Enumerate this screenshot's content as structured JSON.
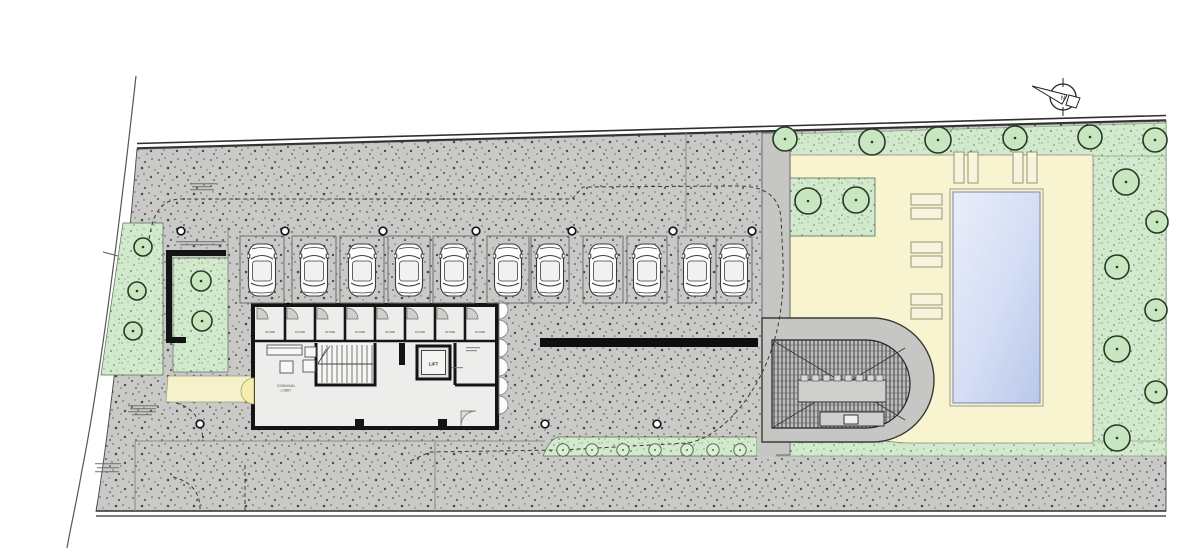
{
  "plan": {
    "labels": {
      "lift": "LIFT",
      "lobby_line1": "COMMUNAL",
      "lobby_line2": "LOBBY",
      "store": "STORE",
      "north": "N"
    },
    "counts": {
      "parking_spaces": 11,
      "storage_rooms": 8,
      "sun_loungers": 10,
      "trees": 20,
      "hedge_bushes": 7
    },
    "colors": {
      "paving_speckled": "#c9c9c7",
      "driveway_gray": "#c6c6c4",
      "lawn_green": "#d3e9cd",
      "pool_deck_yellow": "#f8f4d0",
      "pool_blue": "#c5d4ef",
      "walkway_yellow": "#f5f1cb",
      "wall_black": "#141414"
    },
    "parking": {
      "y": 236,
      "h": 67,
      "bays": [
        [
          240,
          44
        ],
        [
          292,
          44
        ],
        [
          340,
          44
        ],
        [
          388,
          42
        ],
        [
          433,
          42
        ],
        [
          487,
          42
        ],
        [
          531,
          38
        ],
        [
          583,
          40
        ],
        [
          627,
          40
        ],
        [
          678,
          38
        ],
        [
          716,
          36
        ]
      ]
    },
    "trees": [
      [
        143,
        247,
        9
      ],
      [
        137,
        291,
        9
      ],
      [
        133,
        331,
        9
      ],
      [
        201,
        281,
        10
      ],
      [
        202,
        321,
        10
      ],
      [
        808,
        201,
        13
      ],
      [
        856,
        200,
        13
      ],
      [
        785,
        139,
        12
      ],
      [
        872,
        142,
        13
      ],
      [
        938,
        140,
        13
      ],
      [
        1015,
        138,
        12
      ],
      [
        1090,
        137,
        12
      ],
      [
        1155,
        140,
        12
      ],
      [
        1126,
        182,
        13
      ],
      [
        1157,
        222,
        11
      ],
      [
        1117,
        267,
        12
      ],
      [
        1156,
        310,
        11
      ],
      [
        1117,
        349,
        13
      ],
      [
        1156,
        392,
        11
      ],
      [
        1117,
        438,
        13
      ]
    ],
    "bushes": [
      563,
      592,
      623,
      655,
      687,
      713,
      740
    ],
    "bush_y": 450,
    "bollards": [
      [
        181,
        231
      ],
      [
        285,
        231
      ],
      [
        383,
        231
      ],
      [
        476,
        231
      ],
      [
        572,
        231
      ],
      [
        673,
        231
      ],
      [
        752,
        231
      ],
      [
        200,
        424
      ],
      [
        545,
        424
      ],
      [
        657,
        424
      ]
    ],
    "loungers": [
      {
        "x": 911,
        "y": 194,
        "w": 31,
        "h": 11
      },
      {
        "x": 911,
        "y": 208,
        "w": 31,
        "h": 11
      },
      {
        "x": 911,
        "y": 242,
        "w": 31,
        "h": 11
      },
      {
        "x": 911,
        "y": 256,
        "w": 31,
        "h": 11
      },
      {
        "x": 911,
        "y": 294,
        "w": 31,
        "h": 11
      },
      {
        "x": 911,
        "y": 308,
        "w": 31,
        "h": 11
      },
      {
        "x": 954,
        "y": 152,
        "w": 10,
        "h": 31
      },
      {
        "x": 968,
        "y": 152,
        "w": 10,
        "h": 31
      },
      {
        "x": 1013,
        "y": 152,
        "w": 10,
        "h": 31
      },
      {
        "x": 1027,
        "y": 152,
        "w": 10,
        "h": 31
      }
    ],
    "storage": {
      "x0": 255,
      "x1": 495,
      "rooms": 8,
      "top": 307,
      "bottom": 341
    }
  }
}
